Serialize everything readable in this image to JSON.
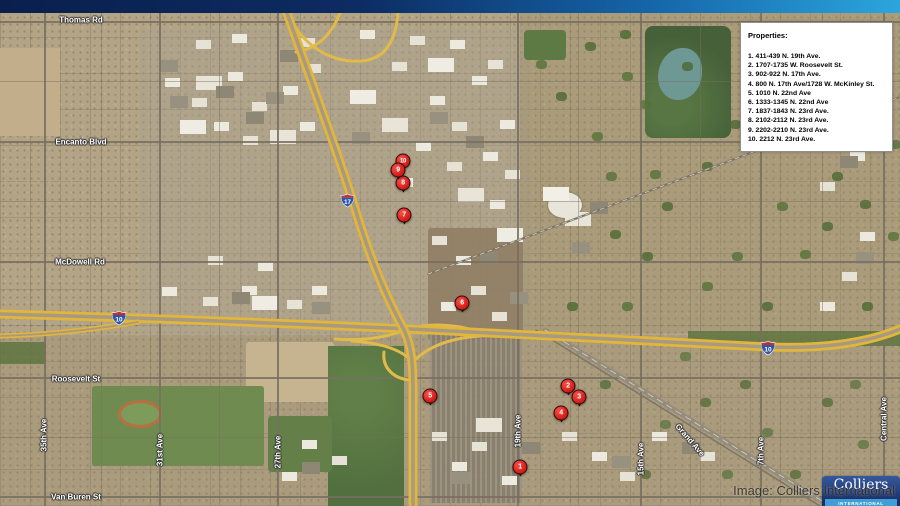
{
  "legend": {
    "title": "Properties:",
    "items": [
      "1. 411-439 N. 19th Ave.",
      "2. 1707-1735 W. Roosevelt St.",
      "3. 902-922 N. 17th Ave.",
      "4. 800 N. 17th Ave/1728 W. McKinley St.",
      "5. 1010 N. 22nd Ave",
      "6. 1333-1345 N. 22nd Ave",
      "7. 1837-1843 N. 23rd Ave.",
      "8. 2102-2112 N. 23rd Ave.",
      "9. 2202-2210 N. 23rd Ave.",
      "10. 2212 N. 23rd Ave."
    ]
  },
  "map": {
    "marker_color": "#d92121",
    "highway_color": "#e2b63b",
    "markers": [
      {
        "label": "1",
        "x": 520,
        "y": 467
      },
      {
        "label": "2",
        "x": 568,
        "y": 386
      },
      {
        "label": "3",
        "x": 579,
        "y": 397
      },
      {
        "label": "4",
        "x": 561,
        "y": 413
      },
      {
        "label": "5",
        "x": 430,
        "y": 396
      },
      {
        "label": "6",
        "x": 462,
        "y": 303
      },
      {
        "label": "7",
        "x": 404,
        "y": 215
      },
      {
        "label": "8",
        "x": 403,
        "y": 183
      },
      {
        "label": "9",
        "x": 398,
        "y": 170
      },
      {
        "label": "10",
        "x": 403,
        "y": 161,
        "z": 29
      }
    ],
    "street_labels": [
      {
        "text": "Thomas Rd",
        "x": 81,
        "y": 20,
        "rot": 0
      },
      {
        "text": "Encanto Blvd",
        "x": 81,
        "y": 142,
        "rot": 0
      },
      {
        "text": "McDowell Rd",
        "x": 80,
        "y": 262,
        "rot": 0
      },
      {
        "text": "Roosevelt St",
        "x": 76,
        "y": 379,
        "rot": 0
      },
      {
        "text": "Van Buren St",
        "x": 76,
        "y": 497,
        "rot": 0
      },
      {
        "text": "35th Ave",
        "x": 44,
        "y": 435,
        "rot": -90
      },
      {
        "text": "31st Ave",
        "x": 160,
        "y": 450,
        "rot": -90
      },
      {
        "text": "27th Ave",
        "x": 278,
        "y": 452,
        "rot": -90
      },
      {
        "text": "19th Ave",
        "x": 518,
        "y": 431,
        "rot": -90
      },
      {
        "text": "15th Ave",
        "x": 641,
        "y": 459,
        "rot": -90
      },
      {
        "text": "7th Ave",
        "x": 761,
        "y": 451,
        "rot": -90
      },
      {
        "text": "Central Ave",
        "x": 884,
        "y": 419,
        "rot": -90
      },
      {
        "text": "Grand Ave",
        "x": 690,
        "y": 440,
        "rot": 49
      }
    ],
    "shields": [
      {
        "route": "17"
      },
      {
        "route": "10"
      },
      {
        "route": "10"
      }
    ]
  },
  "watermark": "Image: Colliers International",
  "logo": {
    "name": "Colliers",
    "subtitle": "INTERNATIONAL"
  }
}
